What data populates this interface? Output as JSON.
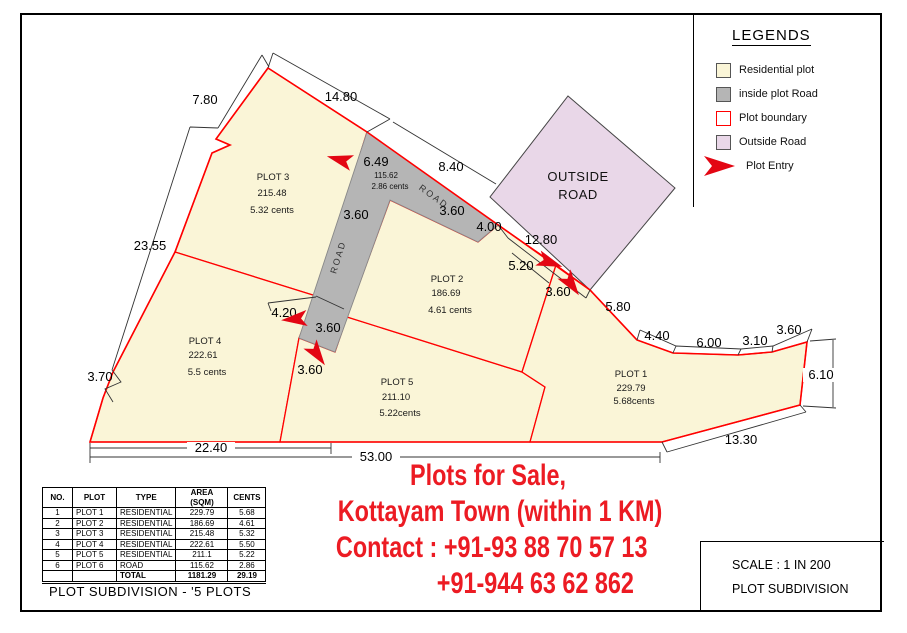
{
  "colors": {
    "residential_fill": "#faf5d7",
    "inside_road_fill": "#b5b5b5",
    "outside_road_fill": "#e9d7e8",
    "plot_boundary": "#ff0000",
    "entry_arrow": "#e30613",
    "ad_text": "#ec1b23"
  },
  "legends": {
    "title": "LEGENDS",
    "items": [
      {
        "label": "Residential plot"
      },
      {
        "label": "inside plot Road"
      },
      {
        "label": "Plot boundary"
      },
      {
        "label": "Outside Road"
      },
      {
        "label": "Plot Entry"
      }
    ]
  },
  "map": {
    "outside_road_line1": "OUTSIDE",
    "outside_road_line2": "ROAD",
    "road_text": "ROAD",
    "road_area": "115.62",
    "road_cents": "2.86 cents",
    "plots": {
      "p1": {
        "name": "PLOT 1",
        "area": "229.79",
        "cents": "5.68cents"
      },
      "p2": {
        "name": "PLOT 2",
        "area": "186.69",
        "cents": "4.61 cents"
      },
      "p3": {
        "name": "PLOT 3",
        "area": "215.48",
        "cents": "5.32 cents"
      },
      "p4": {
        "name": "PLOT 4",
        "area": "222.61",
        "cents": "5.5 cents"
      },
      "p5": {
        "name": "PLOT 5",
        "area": "211.10",
        "cents": "5.22cents"
      }
    },
    "dims": [
      "7.80",
      "14.80",
      "8.40",
      "6.49",
      "3.60",
      "4.00",
      "12.80",
      "5.20",
      "3.60",
      "5.80",
      "4.40",
      "6.00",
      "3.10",
      "3.60",
      "6.10",
      "13.30",
      "23.55",
      "3.70",
      "4.20",
      "3.60",
      "3.60",
      "3.60",
      "22.40",
      "53.00"
    ]
  },
  "table": {
    "headers": [
      "NO.",
      "PLOT",
      "TYPE",
      "AREA (SQM)",
      "CENTS"
    ],
    "rows": [
      {
        "no": "1",
        "plot": "PLOT 1",
        "type": "RESIDENTIAL",
        "area": "229.79",
        "cents": "5.68"
      },
      {
        "no": "2",
        "plot": "PLOT 2",
        "type": "RESIDENTIAL",
        "area": "186.69",
        "cents": "4.61"
      },
      {
        "no": "3",
        "plot": "PLOT 3",
        "type": "RESIDENTIAL",
        "area": "215.48",
        "cents": "5.32"
      },
      {
        "no": "4",
        "plot": "PLOT 4",
        "type": "RESIDENTIAL",
        "area": "222.61",
        "cents": "5.50"
      },
      {
        "no": "5",
        "plot": "PLOT 5",
        "type": "RESIDENTIAL",
        "area": "211.1",
        "cents": "5.22"
      },
      {
        "no": "6",
        "plot": "PLOT 6",
        "type": "ROAD",
        "area": "115.62",
        "cents": "2.86"
      }
    ],
    "total": {
      "label": "TOTAL",
      "area": "1181.29",
      "cents": "29.19"
    }
  },
  "caption": "PLOT SUBDIVISION - '5 PLOTS",
  "ad": {
    "line1": "Plots for Sale,",
    "line2": "Kottayam Town (within 1 KM)",
    "line3": "Contact : +91-93 88 70 57 13",
    "line4": "+91-944 63 62 862"
  },
  "scale_box": {
    "scale": "SCALE : 1 IN 200",
    "subtitle": "PLOT SUBDIVISION"
  }
}
